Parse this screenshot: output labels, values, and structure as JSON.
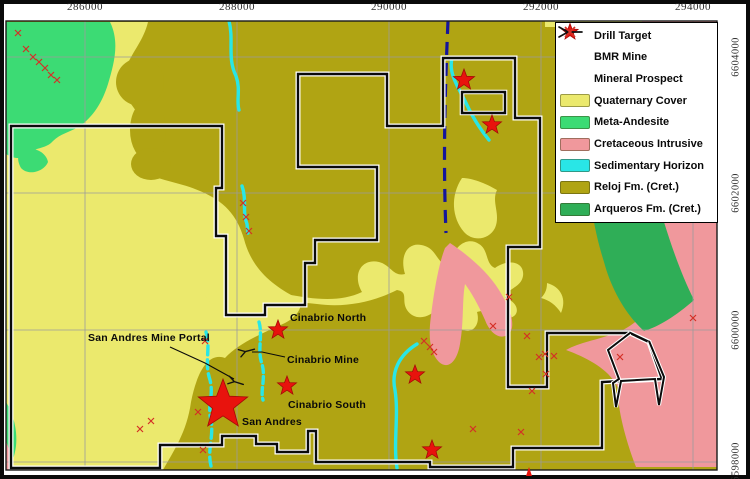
{
  "axis": {
    "top_ticks": [
      {
        "label": "286000",
        "x": 85
      },
      {
        "label": "288000",
        "x": 237
      },
      {
        "label": "290000",
        "x": 389
      },
      {
        "label": "292000",
        "x": 541
      },
      {
        "label": "294000",
        "x": 693
      }
    ],
    "right_ticks": [
      {
        "label": "6604000",
        "y": 57
      },
      {
        "label": "6602000",
        "y": 193
      },
      {
        "label": "6600000",
        "y": 330
      },
      {
        "label": "6598000",
        "y": 462
      }
    ]
  },
  "legend": {
    "items": [
      {
        "label": "Drill Target",
        "symbol": "star",
        "color": "#e8130d"
      },
      {
        "label": "BMR Mine",
        "symbol": "mine",
        "color": "#111111"
      },
      {
        "label": "Mineral Prospect",
        "symbol": "cross",
        "color": "#d43026"
      },
      {
        "label": "Quaternary Cover",
        "symbol": "patch",
        "color": "#ebe96d"
      },
      {
        "label": "Meta-Andesite",
        "symbol": "patch",
        "color": "#3cdb74"
      },
      {
        "label": "Cretaceous Intrusive",
        "symbol": "patch",
        "color": "#f0989c"
      },
      {
        "label": "Sedimentary Horizon",
        "symbol": "patch",
        "color": "#29e6e6"
      },
      {
        "label": "Reloj Fm. (Cret.)",
        "symbol": "patch",
        "color": "#b0a413"
      },
      {
        "label": "Arqueros Fm. (Cret.)",
        "symbol": "patch",
        "color": "#2fae57"
      }
    ]
  },
  "map_labels": [
    {
      "id": "cinabrio-north",
      "text": "Cinabrio North",
      "x": 290,
      "y": 318
    },
    {
      "id": "san-andres-mine-portal",
      "text": "San Andres Mine Portal",
      "x": 88,
      "y": 338
    },
    {
      "id": "cinabrio-mine",
      "text": "Cinabrio Mine",
      "x": 287,
      "y": 360
    },
    {
      "id": "cinabrio-south",
      "text": "Cinabrio South",
      "x": 288,
      "y": 405
    },
    {
      "id": "san-andres",
      "text": "San Andres",
      "x": 242,
      "y": 422
    }
  ],
  "markers": {
    "drill_targets": [
      {
        "x": 464,
        "y": 80,
        "r": 11
      },
      {
        "x": 492,
        "y": 125,
        "r": 10
      },
      {
        "x": 278,
        "y": 330,
        "r": 10
      },
      {
        "x": 287,
        "y": 386,
        "r": 10
      },
      {
        "x": 415,
        "y": 375,
        "r": 10
      },
      {
        "x": 432,
        "y": 450,
        "r": 10
      },
      {
        "x": 223,
        "y": 405,
        "r": 26
      }
    ],
    "bmr_mines": [
      {
        "x": 247,
        "y": 351,
        "rot": -20
      },
      {
        "x": 236,
        "y": 382,
        "rot": 12
      }
    ],
    "mineral_prospects": [
      [
        18,
        33
      ],
      [
        26,
        49
      ],
      [
        33,
        57
      ],
      [
        39,
        62
      ],
      [
        45,
        68
      ],
      [
        51,
        75
      ],
      [
        57,
        80
      ],
      [
        243,
        203
      ],
      [
        246,
        217
      ],
      [
        249,
        231
      ],
      [
        424,
        341
      ],
      [
        430,
        347
      ],
      [
        434,
        352
      ],
      [
        493,
        326
      ],
      [
        509,
        297
      ],
      [
        527,
        336
      ],
      [
        539,
        357
      ],
      [
        546,
        374
      ],
      [
        532,
        391
      ],
      [
        521,
        432
      ],
      [
        473,
        429
      ],
      [
        140,
        429
      ],
      [
        151,
        421
      ],
      [
        545,
        354
      ],
      [
        554,
        356
      ],
      [
        620,
        357
      ],
      [
        693,
        318
      ],
      [
        205,
        341
      ],
      [
        198,
        412
      ],
      [
        203,
        450
      ]
    ]
  },
  "colors": {
    "quaternary": "#ebe96d",
    "meta_andesite": "#3cdb74",
    "cretaceous_intrusive": "#f0989c",
    "sedimentary_horizon": "#29e6e6",
    "reloj": "#b0a413",
    "arqueros": "#2fae57",
    "drill_red": "#e8130d",
    "prospect_red": "#d43026",
    "dashed_line_blue": "#15159b",
    "grid_gray": "#9b9b9b",
    "boundary_black": "#0b0b0b"
  }
}
